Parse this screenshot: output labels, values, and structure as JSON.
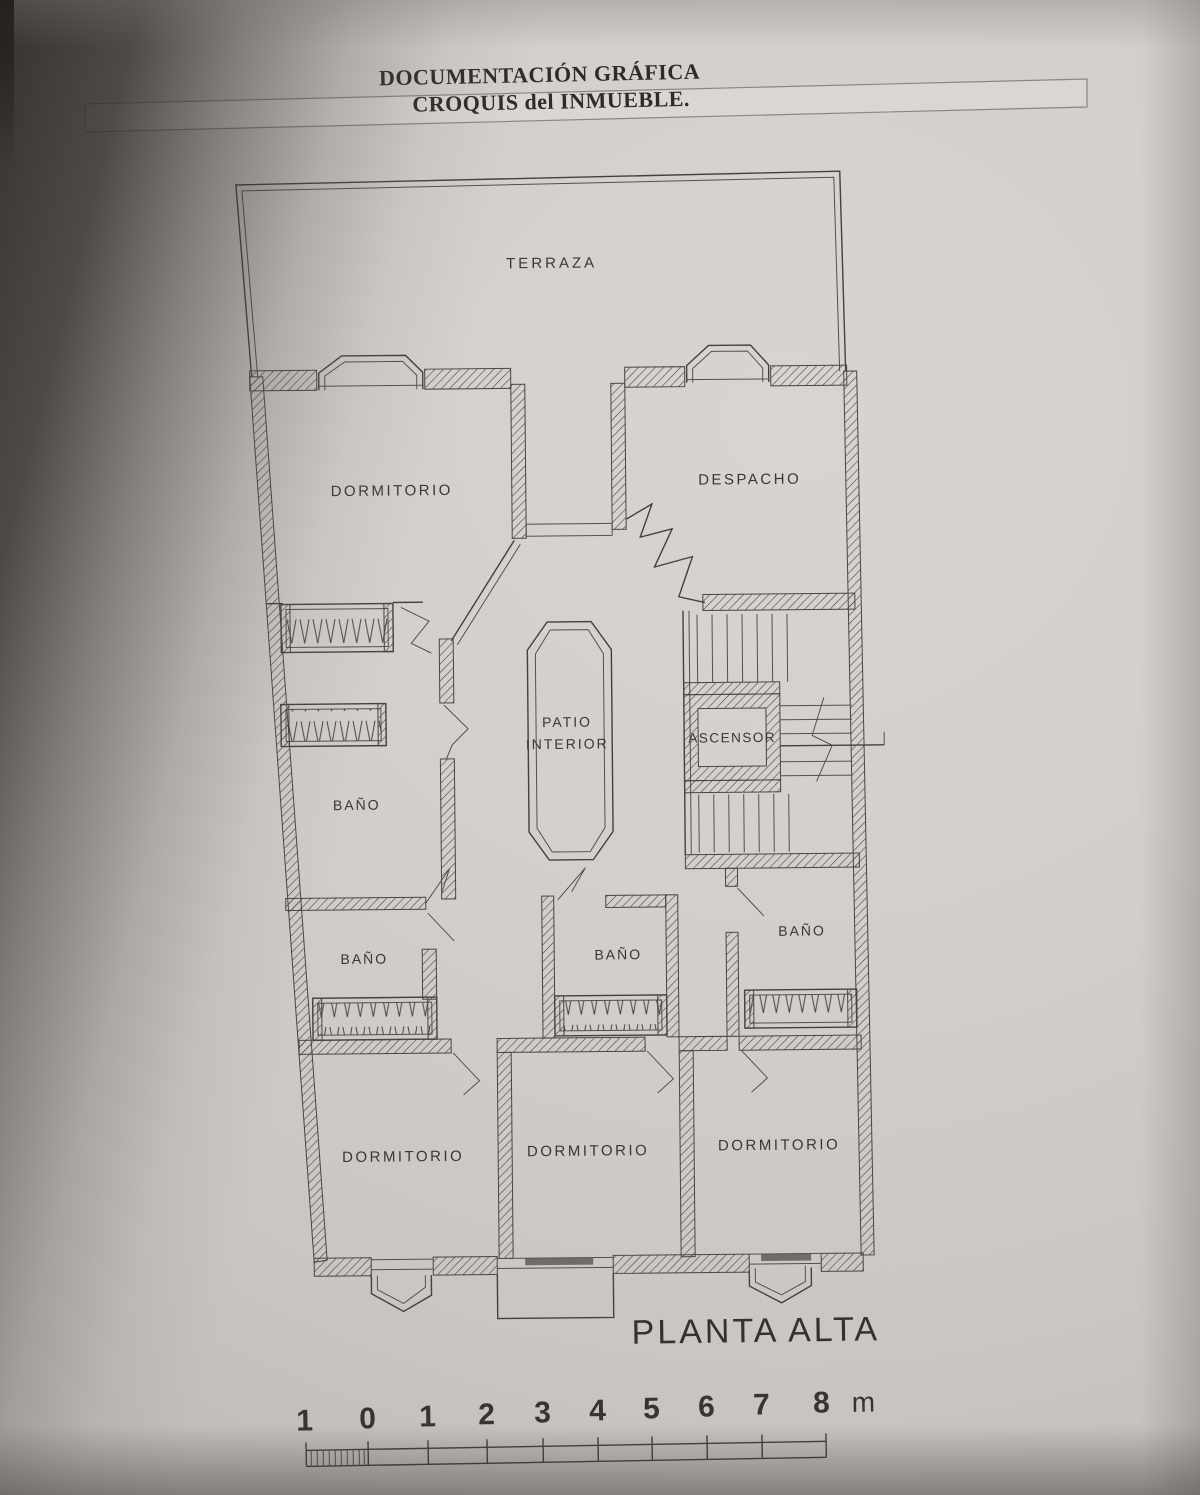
{
  "header": {
    "title": "DOCUMENTACIÓN GRÁFICA",
    "subtitle": "CROQUIS del INMUEBLE."
  },
  "plan": {
    "title": "PLANTA ALTA",
    "rooms": {
      "terraza": "TERRAZA",
      "dormitorio_top": "DORMITORIO",
      "despacho": "DESPACHO",
      "patio_line1": "PATIO",
      "patio_line2": "INTERIOR",
      "ascensor": "ASCENSOR",
      "bano_left_upper": "BAÑO",
      "bano_left_lower": "BAÑO",
      "bano_middle": "BAÑO",
      "bano_right": "BAÑO",
      "dormitorio_bottom_left": "DORMITORIO",
      "dormitorio_bottom_middle": "DORMITORIO",
      "dormitorio_bottom_right": "DORMITORIO"
    }
  },
  "scale": {
    "ticks": [
      "1",
      "0",
      "1",
      "2",
      "3",
      "4",
      "5",
      "6",
      "7",
      "8"
    ],
    "unit": "m"
  },
  "colors": {
    "paper": "#d2cecb",
    "ink": "#44403d",
    "shadow": "#39332f",
    "band_fill": "#d9d6d3"
  }
}
